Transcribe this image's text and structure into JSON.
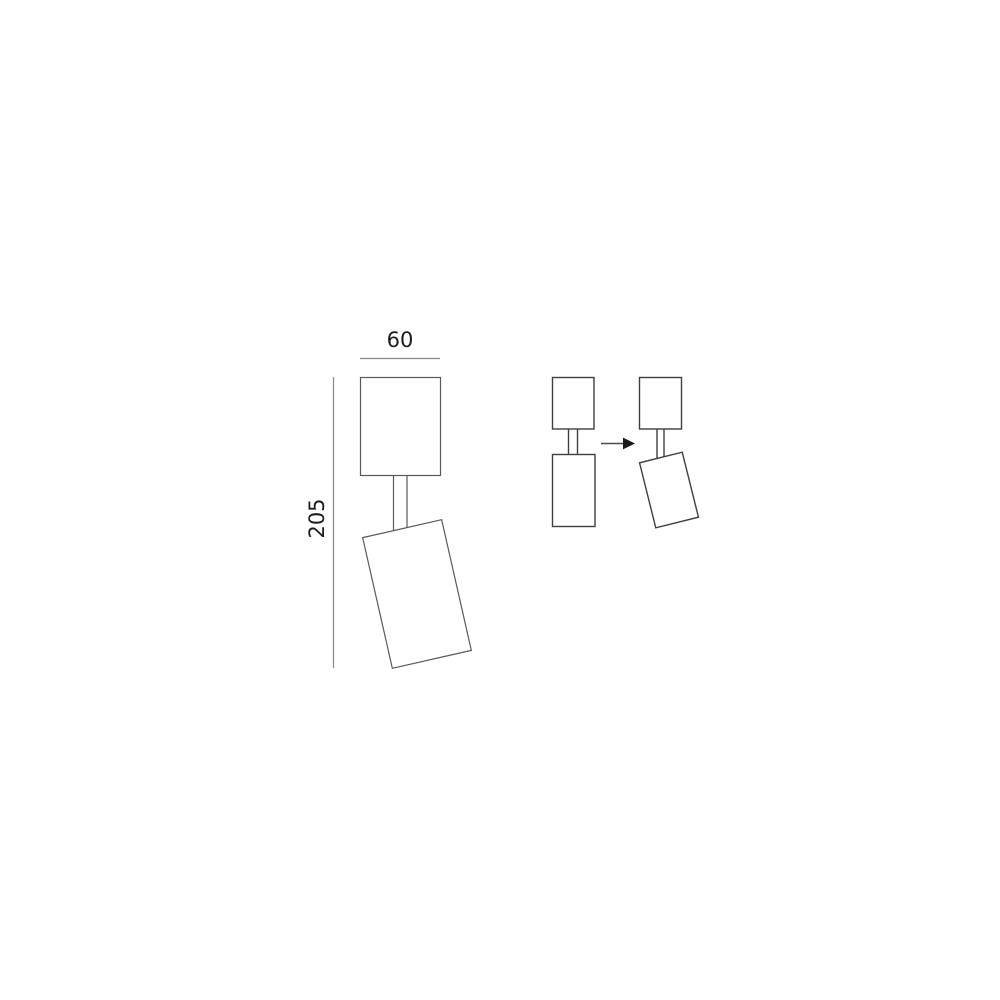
{
  "canvas": {
    "background": "#ffffff"
  },
  "colors": {
    "label_ink": "#1c1c1e",
    "main_outline": "#58595b",
    "dimension_line": "#87888a",
    "detail_outline": "#3e3f41",
    "arrow_shaft": "#4a4b4d",
    "arrow_head": "#1a1a1a",
    "fill_blank": "#ffffff"
  },
  "dimensions": {
    "width": {
      "label": "60"
    },
    "height": {
      "label": "205"
    }
  },
  "icons": {
    "transform_arrow": "arrow-right-icon"
  }
}
